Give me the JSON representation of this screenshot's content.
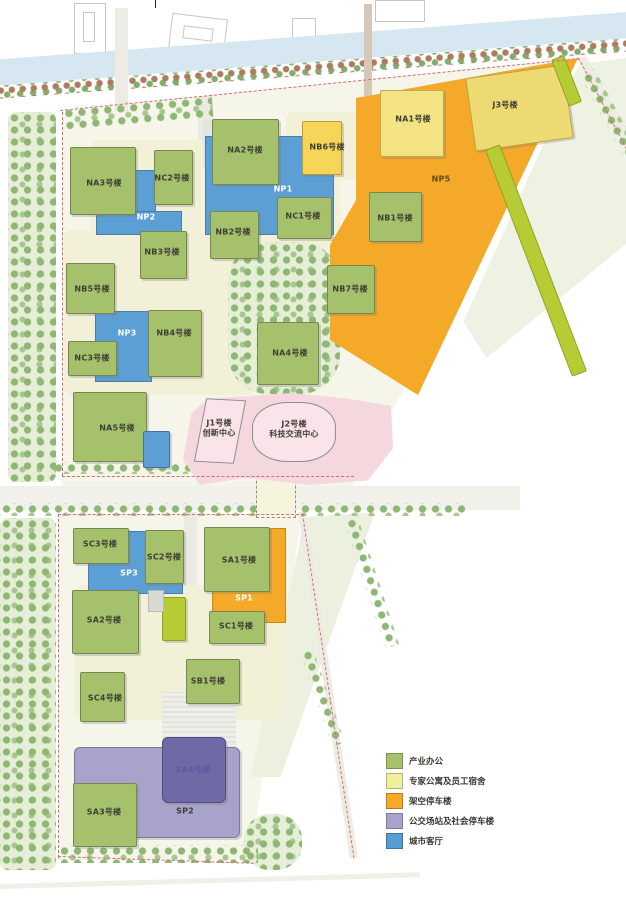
{
  "legend": {
    "items": [
      {
        "label": "产业办公",
        "color": "#a6c16b"
      },
      {
        "label": "专家公寓及员工宿舍",
        "color": "#f3ee9d"
      },
      {
        "label": "架空停车楼",
        "color": "#f4a929"
      },
      {
        "label": "公交场站及社会停车楼",
        "color": "#a8a3cb"
      },
      {
        "label": "城市客厅",
        "color": "#569dd2"
      }
    ]
  },
  "labels": {
    "na1": "NA1号楼",
    "na2": "NA2号楼",
    "na3": "NA3号楼",
    "na4": "NA4号楼",
    "na5": "NA5号楼",
    "nb1": "NB1号楼",
    "nb2": "NB2号楼",
    "nb3": "NB3号楼",
    "nb4": "NB4号楼",
    "nb5": "NB5号楼",
    "nb6": "NB6号楼",
    "nb7": "NB7号楼",
    "nc1": "NC1号楼",
    "nc2": "NC2号楼",
    "nc3": "NC3号楼",
    "np1": "NP1",
    "np2": "NP2",
    "np3": "NP3",
    "np5": "NP5",
    "j1": "J1号楼",
    "j1_sub": "创新中心",
    "j2": "J2号楼",
    "j2_sub": "科技交流中心",
    "j3": "J3号楼",
    "sa1": "SA1号楼",
    "sa2": "SA2号楼",
    "sa3": "SA3号楼",
    "sa4": "SA4号楼",
    "sb1": "SB1号楼",
    "sc1": "SC1号楼",
    "sc2": "SC2号楼",
    "sc3": "SC3号楼",
    "sc4": "SC4号楼",
    "sp1": "SP1",
    "sp2": "SP2",
    "sp3": "SP3"
  }
}
